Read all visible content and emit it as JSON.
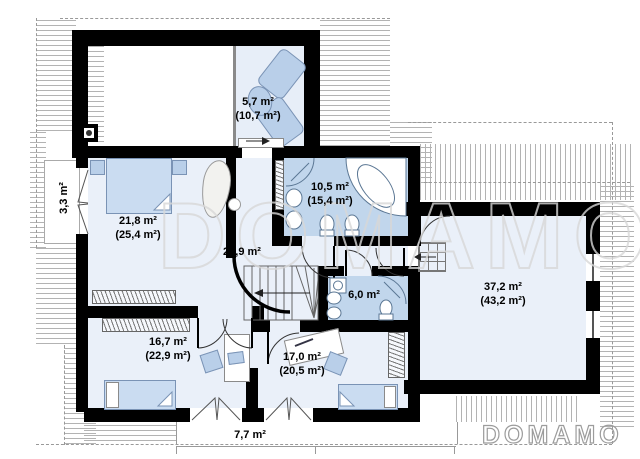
{
  "watermark": "DOMAMO",
  "brand_logo": "DOMAMO",
  "rooms": {
    "upper_loggia": {
      "area": "5,7 m²",
      "total": "(10,7 m²)"
    },
    "balcony_left": {
      "area": "3,3 m²"
    },
    "master_bedroom": {
      "area": "21,8 m²",
      "total": "(25,4 m²)"
    },
    "main_bathroom": {
      "area": "10,5 m²",
      "total": "(15,4 m²)"
    },
    "hall": {
      "area": "22,9 m²"
    },
    "small_bathroom": {
      "area": "6,0 m²"
    },
    "large_room": {
      "area": "37,2 m²",
      "total": "(43,2 m²)"
    },
    "bedroom_left": {
      "area": "16,7 m²",
      "total": "(22,9 m²)"
    },
    "bedroom_right": {
      "area": "17,0 m²",
      "total": "(20,5 m²)"
    },
    "bottom_balcony": {
      "area": "7,7 m²"
    }
  }
}
